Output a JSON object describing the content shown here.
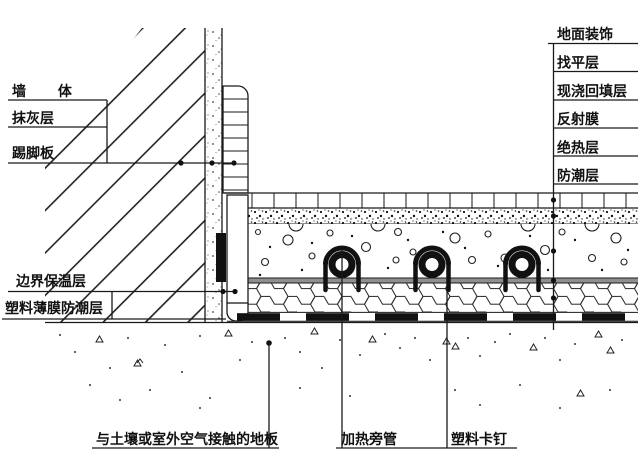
{
  "diagram": {
    "left_labels": [
      {
        "text": "墙 体"
      },
      {
        "text": "抹灰层"
      },
      {
        "text": "踢脚板"
      },
      {
        "text": "边界保温层"
      },
      {
        "text": "塑料薄膜防潮层"
      }
    ],
    "right_labels": [
      {
        "text": "地面装饰"
      },
      {
        "text": "找平层"
      },
      {
        "text": "现浇回填层"
      },
      {
        "text": "反射膜"
      },
      {
        "text": "绝热层"
      },
      {
        "text": "防潮层"
      }
    ],
    "bottom_labels": [
      {
        "text": "与土壤或室外空气接触的地板"
      },
      {
        "text": "加热旁管"
      },
      {
        "text": "塑料卡钉"
      }
    ],
    "colors": {
      "line": "#1a1a1a",
      "reflective_film_gray": "#8f8f8f",
      "background": "#ffffff",
      "fill_black": "#111111"
    }
  }
}
